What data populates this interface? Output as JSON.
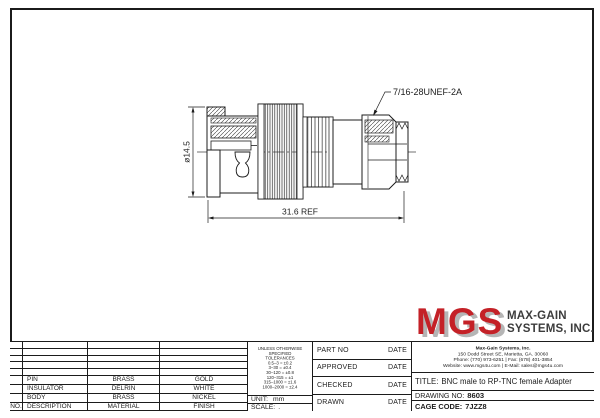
{
  "drawing": {
    "thread_label": "7/16-28UNEF-2A",
    "dim_diameter": "ø14.5",
    "dim_length": "31.6 REF"
  },
  "parts_table": {
    "header": {
      "no": "NO.",
      "description": "DESCRIPTION",
      "material": "MATERIAL",
      "finish": "FINISH"
    },
    "rows": [
      {
        "no": "",
        "description": "PIN",
        "material": "BRASS",
        "finish": "GOLD"
      },
      {
        "no": "",
        "description": "INSULATOR",
        "material": "DELRIN",
        "finish": "WHITE"
      },
      {
        "no": "",
        "description": "BODY",
        "material": "BRASS",
        "finish": "NICKEL"
      }
    ]
  },
  "tolerances": {
    "title1": "UNLESS OTHERWISE",
    "title2": "SPECIFIED TOLERANCES",
    "rows": [
      "0.5–3 = ±0.2",
      "3–30 = ±0.4",
      "30–120 = ±0.8",
      "120–315 = ±1",
      "315–1000 = ±1.6",
      "1000–2000 = ±2.4"
    ],
    "unit_label": "UNIT:",
    "unit_value": "mm",
    "scale_label": "SCALE:",
    "scale_value": "."
  },
  "signoff": {
    "rows": [
      {
        "label": "PART NO",
        "date": "DATE"
      },
      {
        "label": "APPROVED",
        "date": "DATE"
      },
      {
        "label": "CHECKED",
        "date": "DATE"
      },
      {
        "label": "DRAWN",
        "date": "DATE"
      }
    ]
  },
  "company": {
    "logo_text": "MGS",
    "logo_color": "#c42127",
    "name_line1": "MAX-GAIN",
    "name_line2": "SYSTEMS, INC.",
    "address_line1": "Max-Gain Systems, Inc.",
    "address_line2": "150 Dodd Street SE, Marietta, GA. 30060",
    "address_line3": "Phone: (770) 973-6251 | Fax: (678) 401-3854",
    "address_line4": "Website: www.mgs4u.com | E-Mail: sales@mgs4u.com"
  },
  "title_block": {
    "title_label": "TITLE:",
    "title_value": "BNC male to RP-TNC female Adapter",
    "drawing_no_label": "DRAWING  NO:",
    "drawing_no_value": "8603",
    "cage_code_label": "CAGE CODE:",
    "cage_code_value": "7JZZ8"
  }
}
